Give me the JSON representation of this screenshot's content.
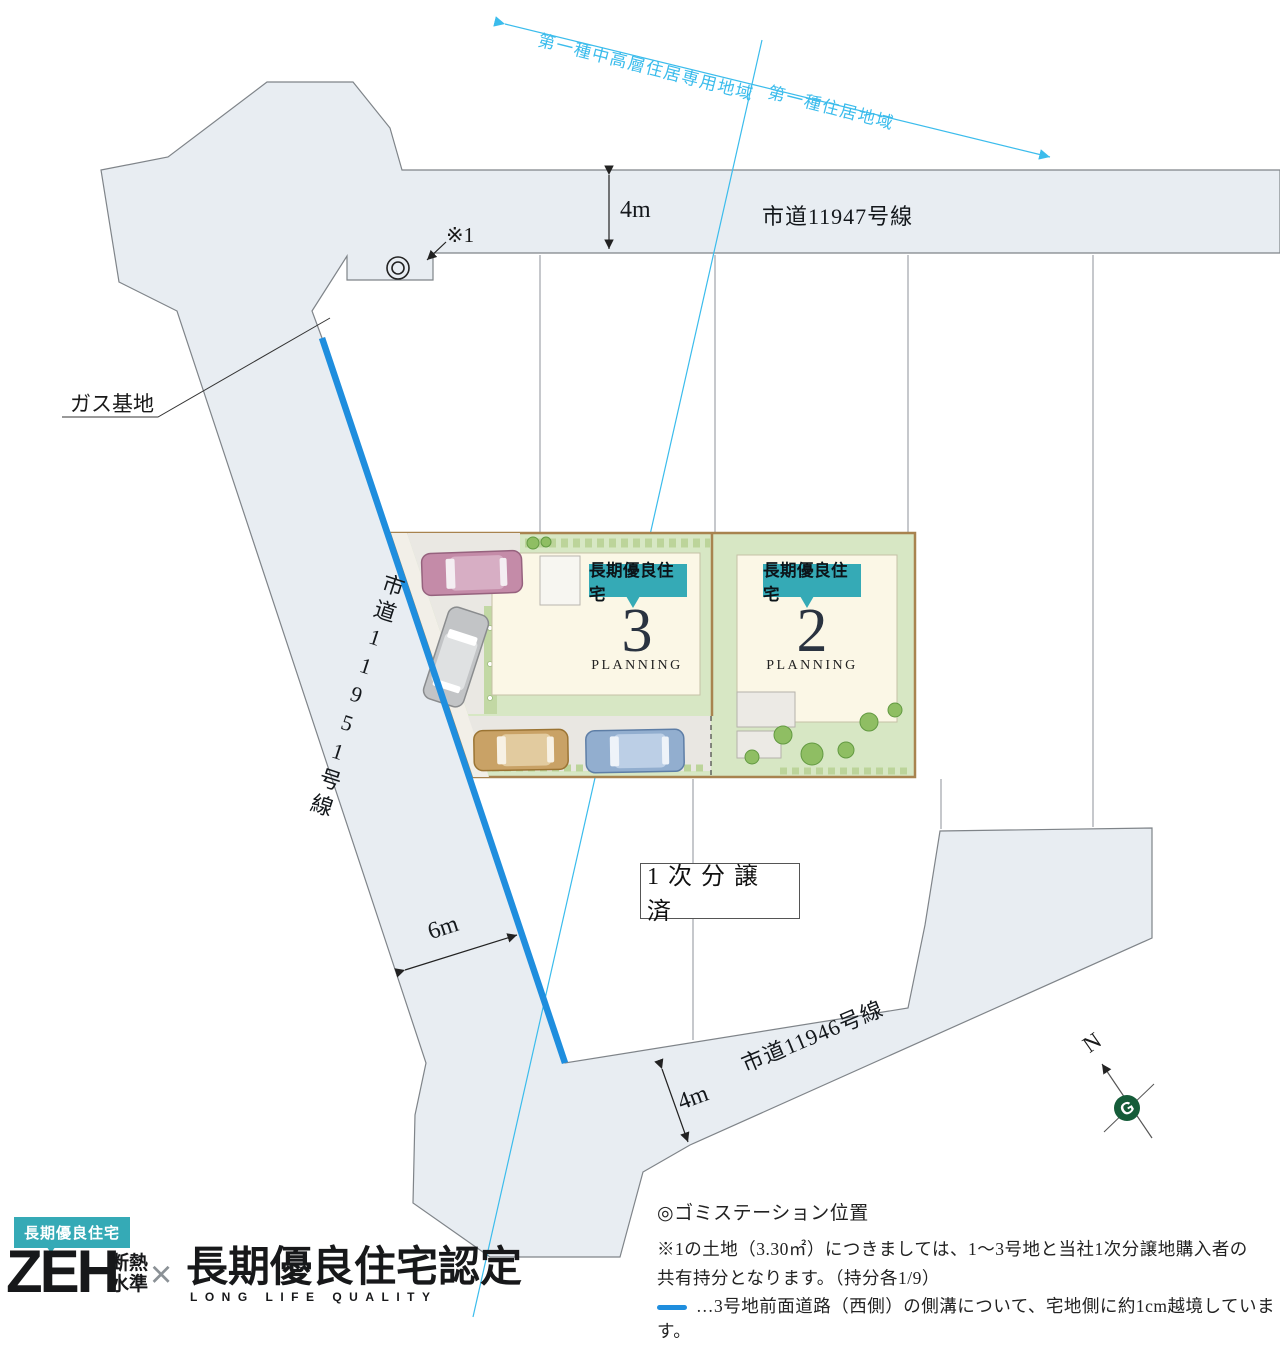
{
  "zoning": {
    "left_label": "第一種中高層住居専用地域",
    "right_label": "第一種住居地域"
  },
  "roads": {
    "top": {
      "name": "市道11947号線",
      "width_label": "4m"
    },
    "west": {
      "name": "市道11951号線",
      "width_label": "6m"
    },
    "south": {
      "name": "市道11946号線",
      "width_label": "4m"
    }
  },
  "annotations": {
    "gas_label": "ガス基地",
    "ref_marker": "※1",
    "sold_box": "1次分譲済",
    "north_letter": "N",
    "compass_letter": "G"
  },
  "lots": {
    "lot3": {
      "badge": "長期優良住宅",
      "number": "3",
      "caption": "PLANNING"
    },
    "lot2": {
      "badge": "長期優良住宅",
      "number": "2",
      "caption": "PLANNING"
    }
  },
  "legend": {
    "garbage_station": "◎ゴミステーション位置",
    "note1_line1": "※1の土地（3.30㎡）につきましては、1～3号地と当社1次分譲地購入者の",
    "note1_line2": "共有持分となります。（持分各1/9）",
    "note2": "…3号地前面道路（西側）の側溝について、宅地側に約1cm越境しています。"
  },
  "logo": {
    "badge": "長期優良住宅",
    "zeh": "ZEH",
    "sub_line1": "断熱",
    "sub_line2": "水準",
    "times": "×",
    "main": "長期優良住宅認定",
    "sub_en": "LONG LIFE QUALITY"
  },
  "colors": {
    "road_fill": "#e8edf2",
    "road_stroke": "#7f8489",
    "accent_teal": "#35aab6",
    "highlight_blue": "#1f8ede",
    "zoning_cyan": "#3bbcec",
    "lot_green": "#d7e7c4",
    "building_cream": "#fbf7e6",
    "navy": "#2a3340",
    "compass_green": "#155c39"
  }
}
